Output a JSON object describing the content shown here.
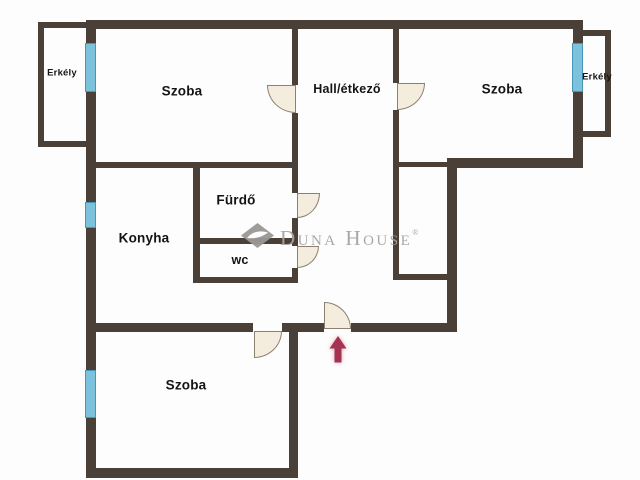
{
  "plan": {
    "rooms": {
      "erkely_left": "Erkély",
      "szoba_top_left": "Szoba",
      "hall": "Hall/étkező",
      "szoba_top_right": "Szoba",
      "erkely_right": "Erkély",
      "furdo": "Fürdő",
      "konyha": "Konyha",
      "wc": "wc",
      "szoba_bottom": "Szoba"
    },
    "watermark": {
      "brand": "Duna House",
      "registered_mark": "®"
    }
  },
  "colors": {
    "wall": "#4b4037",
    "window": "#7cc2dc",
    "window_border": "#4796b8",
    "door_fill": "#f4edde",
    "door_border": "#8c8071",
    "arrow": "#a43352",
    "watermark_gray": "#a6a3a0",
    "label": "#141414",
    "background": "#fdfdfd"
  }
}
